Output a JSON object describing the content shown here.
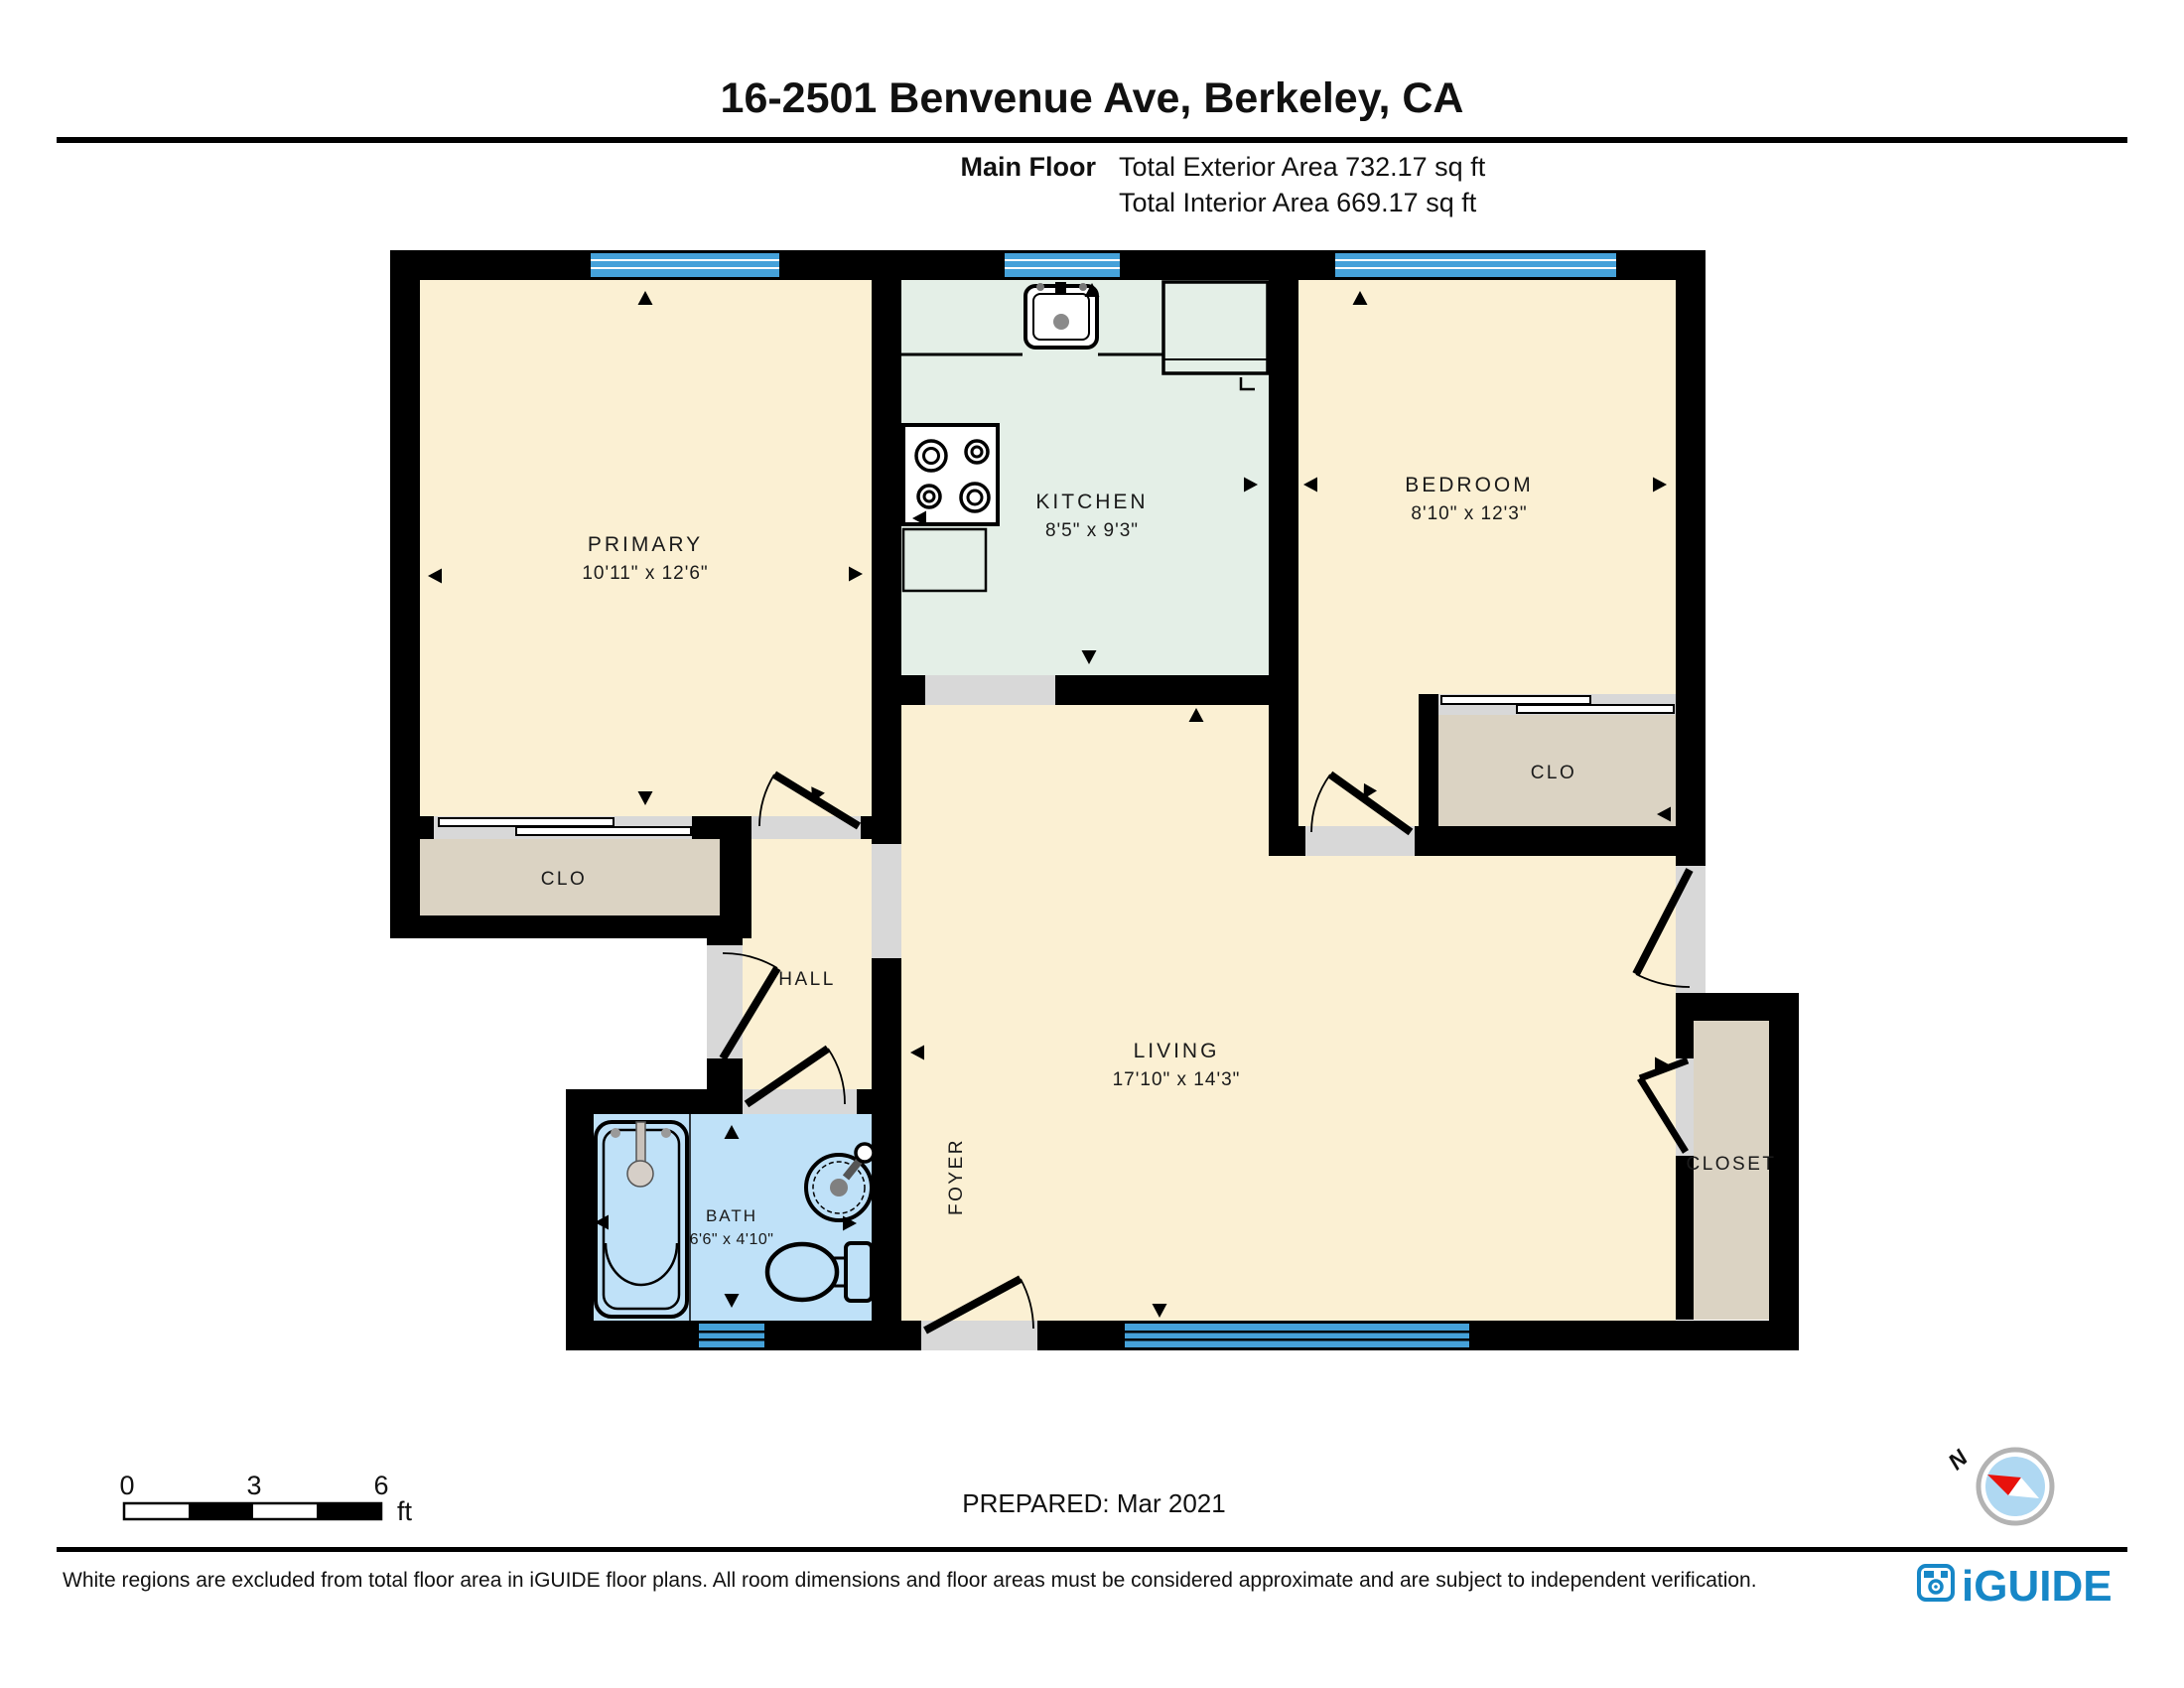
{
  "header": {
    "title": "16-2501 Benvenue Ave, Berkeley, CA",
    "floor_label": "Main Floor",
    "exterior_area": "Total Exterior Area 732.17 sq ft",
    "interior_area": "Total Interior Area 669.17 sq ft"
  },
  "plan": {
    "rooms": {
      "primary": {
        "label": "PRIMARY",
        "dims": "10'11\" x 12'6\""
      },
      "kitchen": {
        "label": "KITCHEN",
        "dims": "8'5\" x 9'3\""
      },
      "bedroom": {
        "label": "BEDROOM",
        "dims": "8'10\" x 12'3\""
      },
      "living": {
        "label": "LIVING",
        "dims": "17'10\" x 14'3\""
      },
      "bath": {
        "label": "BATH",
        "dims": "6'6\" x 4'10\""
      }
    },
    "areas": {
      "hall": "HALL",
      "foyer": "FOYER",
      "primary_closet": "CLO",
      "bedroom_closet": "CLO",
      "living_closet": "CLOSET"
    }
  },
  "scale_bar": {
    "tick_0": "0",
    "tick_3": "3",
    "tick_6": "6",
    "unit": "ft"
  },
  "compass": {
    "north_label": "N"
  },
  "footer": {
    "prepared": "PREPARED: Mar 2021",
    "disclaimer": "White regions are excluded from total floor area in iGUIDE floor plans. All room dimensions and floor areas must be considered approximate and are subject to independent verification.",
    "brand": "iGUIDE"
  },
  "colors": {
    "wall": "#000000",
    "room_cream": "#FBF0D3",
    "kitchen_green": "#E4EFE7",
    "bath_blue": "#BFE1F8",
    "closet_beige": "#DBD3C3",
    "opening_gray": "#D8D8D8",
    "window_blue": "#45A1D9",
    "brand_blue": "#1787C7",
    "compass_fill": "#AFD8F2",
    "compass_needle_red": "#E8120C"
  }
}
